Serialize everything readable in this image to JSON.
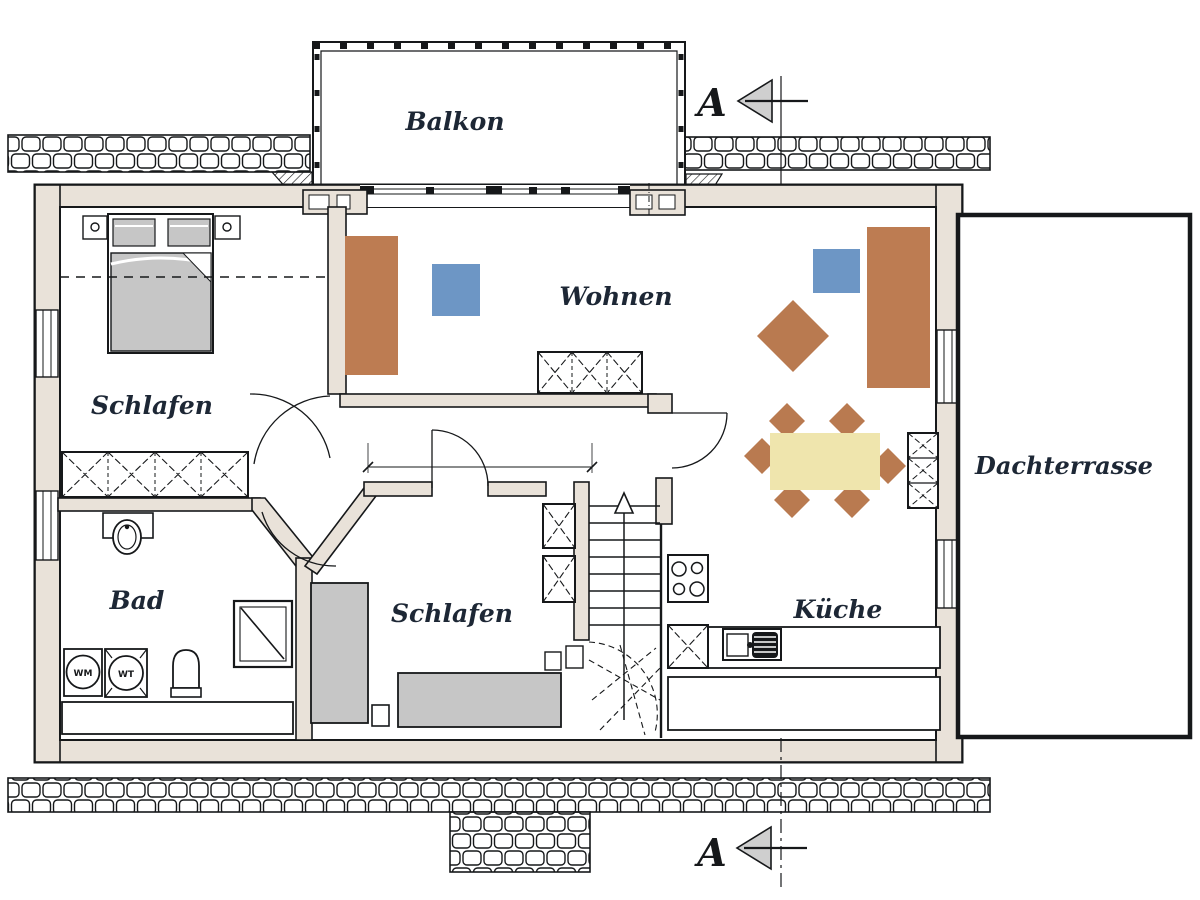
{
  "document": {
    "type": "floor-plan",
    "floor": "upper-storey"
  },
  "labels": {
    "balcony": "Balkon",
    "living_room": "Wohnen",
    "bedroom_top": "Schlafen",
    "bedroom_bottom": "Schlafen",
    "bathroom": "Bad",
    "kitchen": "Küche",
    "roof_terrace": "Dachterrasse",
    "washing_machine": "WM",
    "dryer": "WT",
    "section_top": "A",
    "section_bottom": "A"
  },
  "colors": {
    "wall_fill": "#e9e2d9",
    "outline": "#16181a",
    "sofa_brown": "#bd7c52",
    "chair_brown": "#b97a50",
    "table_cream": "#efe5ad",
    "accent_blue": "#6d96c5",
    "furniture_gray": "#c6c6c6",
    "label_ink": "#1d2735",
    "section_arrow_fill": "#cfcfcf"
  }
}
